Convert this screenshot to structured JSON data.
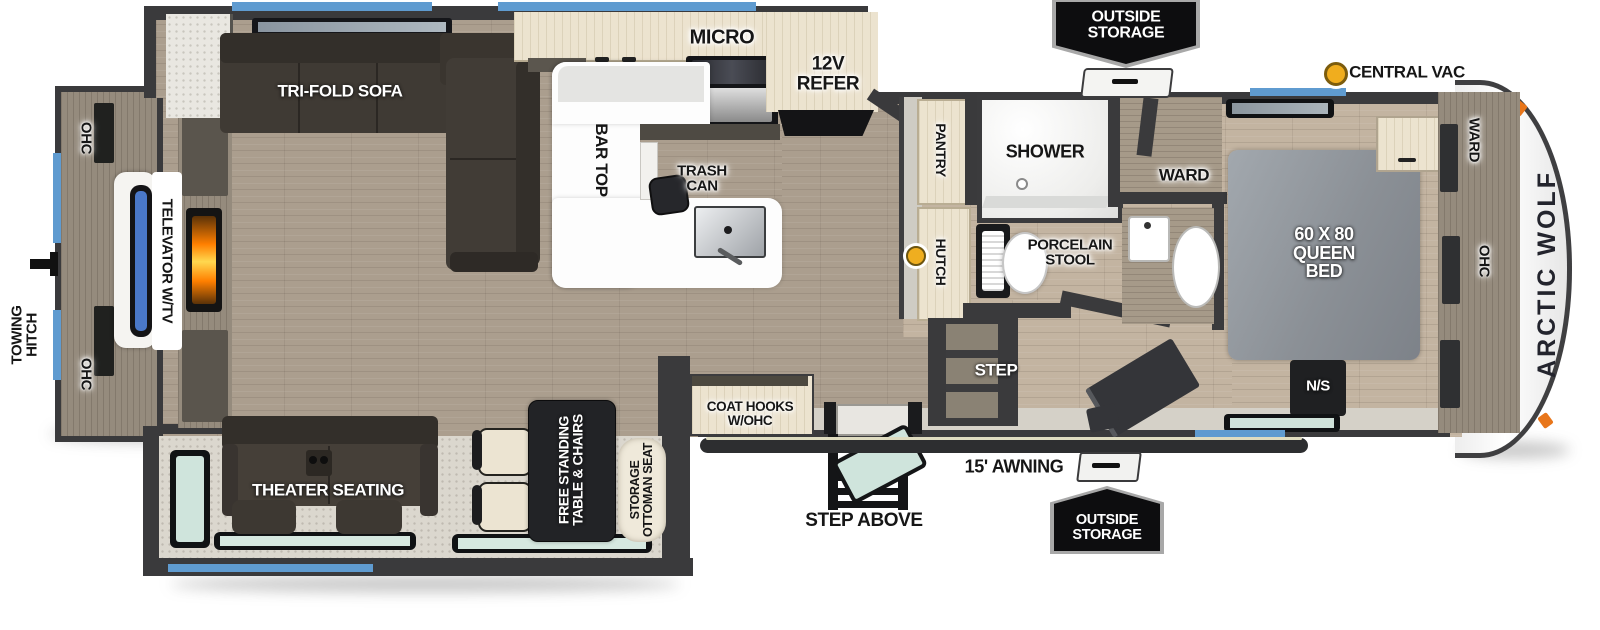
{
  "labels": {
    "towing": [
      "TOWING",
      "HITCH"
    ],
    "ohc_rear_top": "OHC",
    "ohc_rear_bottom": "OHC",
    "televator": "TELEVATOR W/TV",
    "tri_fold_sofa": "TRI-FOLD SOFA",
    "micro": "MICRO",
    "refer": [
      "12V",
      "REFER"
    ],
    "bar_top": "BAR TOP",
    "trash": [
      "TRASH",
      "CAN"
    ],
    "outside_storage_top": [
      "OUTSIDE",
      "STORAGE"
    ],
    "central_vac": "CENTRAL VAC",
    "pantry": "PANTRY",
    "shower": "SHOWER",
    "ward_bath": "WARD",
    "hutch": "HUTCH",
    "porcelain": [
      "PORCELAIN",
      "STOOL"
    ],
    "ward_front": "WARD",
    "ohc_front": "OHC",
    "queen_bed": [
      "60 X 80",
      "QUEEN",
      "BED"
    ],
    "ns": "N/S",
    "brand": "ARCTIC WOLF",
    "step": "STEP",
    "theater": "THEATER SEATING",
    "free_standing": [
      "FREE STANDING",
      "TABLE & CHAIRS"
    ],
    "ottoman": [
      "STORAGE",
      "OTTOMAN SEAT"
    ],
    "coat_hooks": [
      "COAT HOOKS",
      "W/OHC"
    ],
    "step_above": "STEP ABOVE",
    "awning": "15' AWNING",
    "outside_storage_bottom": [
      "OUTSIDE",
      "STORAGE"
    ]
  },
  "colors": {
    "wall": "#3a3a3c",
    "window_blue": "#5f9bd0",
    "window_glass": "#d6e8e0",
    "awning": "#2d2e30",
    "central_vac_dot": "#f0ad1e",
    "marker_orange": "#e8761b",
    "fireplace_glow": "#ff7f00",
    "bed_gray": "#8f949a",
    "counter_tan": "#ece3cf",
    "floor_wood": "#ab9e8e",
    "badge_black": "#0d0d0f",
    "brand_text": "#23242d"
  }
}
